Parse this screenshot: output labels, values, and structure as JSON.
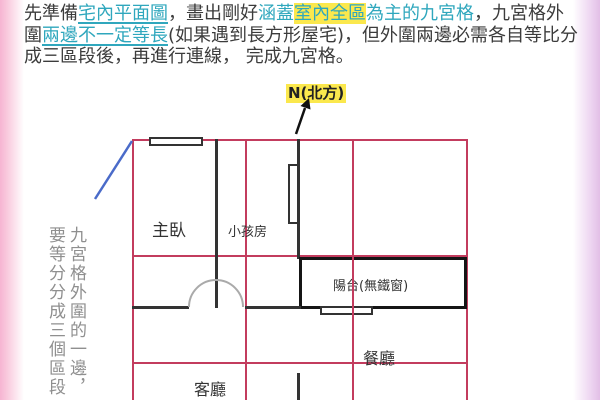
{
  "colors": {
    "accent_teal": "#2fa7bd",
    "highlight_yellow": "#fbe84d",
    "grid_red": "#c33c5e",
    "wall_black": "#333333",
    "side_note_gray": "#8f8f8f",
    "annotation_blue": "#4a6bc9",
    "edge_pink": "#f6b4d2",
    "edge_lavender": "#e2bfe6"
  },
  "intro": {
    "lines": [
      {
        "segments": [
          {
            "text": "先準備",
            "style": "plain"
          },
          {
            "text": "宅內平面圖",
            "style": "teal-underline"
          },
          {
            "text": "，畫出剛好",
            "style": "plain"
          },
          {
            "text": "涵蓋",
            "style": "teal"
          },
          {
            "text": "室內全區",
            "style": "teal-highlight"
          },
          {
            "text": "為主的九宮格",
            "style": "teal"
          },
          {
            "text": "，九宮格外",
            "style": "plain"
          }
        ]
      },
      {
        "segments": [
          {
            "text": "圍",
            "style": "plain"
          },
          {
            "text": "兩邊不一定等長",
            "style": "teal-underline"
          },
          {
            "text": "(如果遇到長方形屋宅)，但外圍兩邊必需各自等比分",
            "style": "plain"
          }
        ]
      },
      {
        "segments": [
          {
            "text": "成三區段後，再進行連線， 完成九宮格。",
            "style": "plain"
          }
        ]
      }
    ]
  },
  "compass": {
    "label": "N(北方)"
  },
  "side_note": {
    "col1": "九宮格外圍的一邊，",
    "col2": "要等分分成三個區段"
  },
  "floor_plan": {
    "rooms": {
      "master_bedroom": "主臥",
      "kids_room": "小孩房",
      "balcony": "陽台(無鐵窗)",
      "dining_room": "餐廳",
      "living_room": "客廳"
    }
  }
}
